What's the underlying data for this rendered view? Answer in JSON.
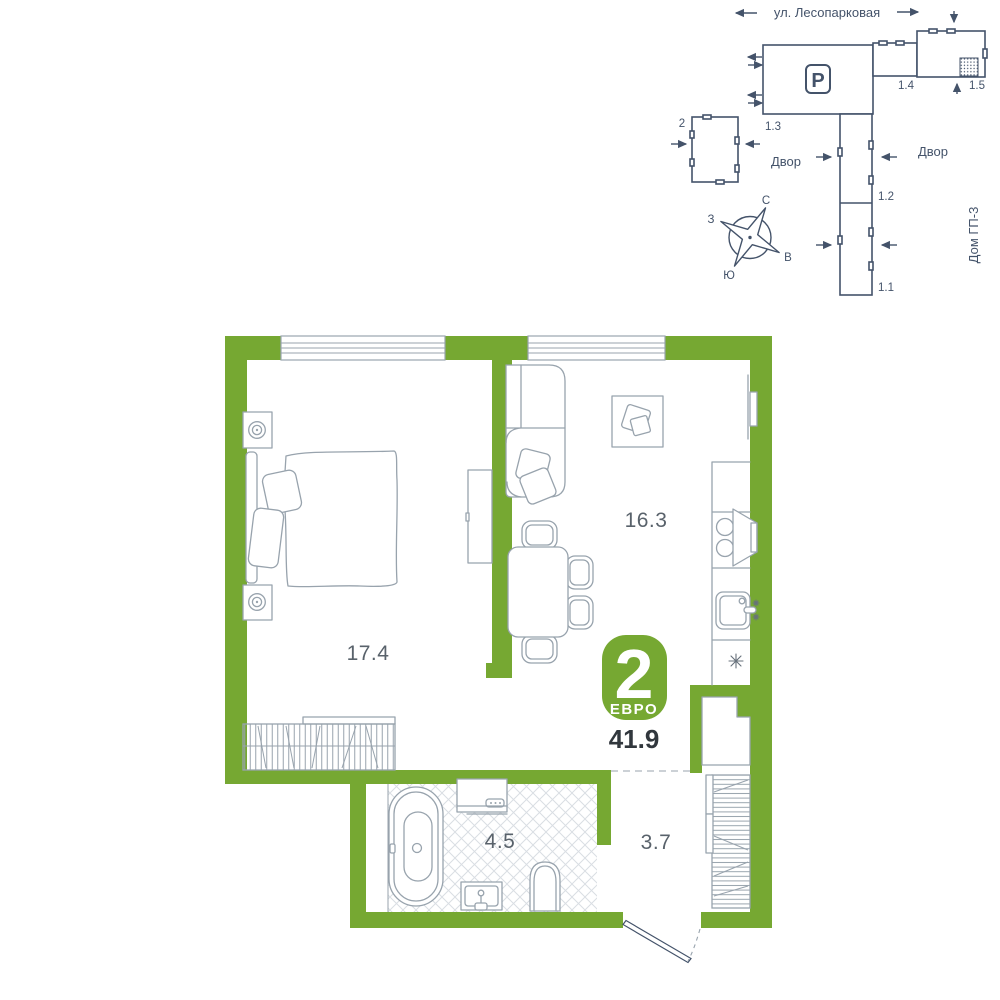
{
  "site_plan": {
    "street_label": "ул. Лесопарковая",
    "parking_icon": "P",
    "building_13": "1.3",
    "building_14": "1.4",
    "building_15": "1.5",
    "building_12": "1.2",
    "building_11": "1.1",
    "building_2": "2",
    "courtyard_left": "Двор",
    "courtyard_right": "Двор",
    "house_label": "Дом ГП-3",
    "compass": {
      "north": "С",
      "south": "Ю",
      "west": "З",
      "east": "В"
    }
  },
  "floor_plan": {
    "badge": {
      "room_count": "2",
      "type_label": "ЕВРО"
    },
    "total_area": "41.9",
    "rooms": {
      "bedroom_area": "17.4",
      "kitchen_living_area": "16.3",
      "bathroom_area": "4.5",
      "hallway_area": "3.7"
    }
  },
  "colors": {
    "wall_green": "#76A832",
    "furniture_line": "#98A3AD",
    "site_line": "#44536A",
    "label_text": "#59626B",
    "area_text": "#31373D",
    "tile_line": "#D9DEE3"
  }
}
